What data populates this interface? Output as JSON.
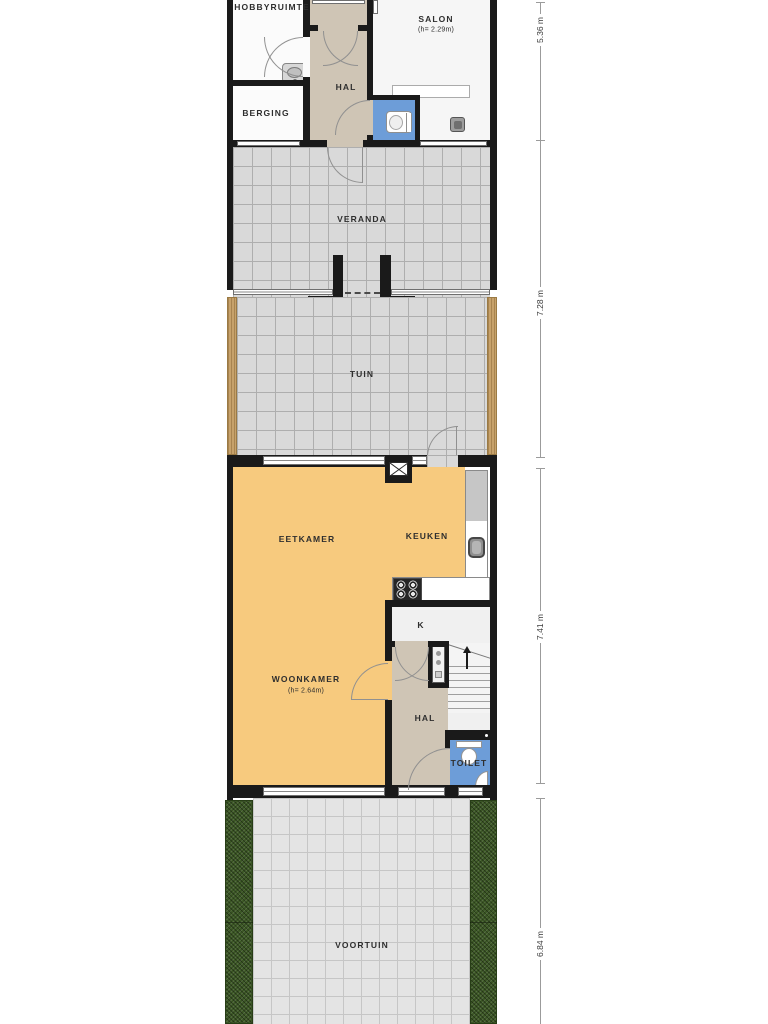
{
  "rooms": {
    "hobbyruimte": {
      "label": "HOBBYRUIMTE"
    },
    "salon": {
      "label": "SALON",
      "height_note": "(h= 2.29m)"
    },
    "hal_boven": {
      "label": "HAL"
    },
    "berging": {
      "label": "BERGING"
    },
    "veranda": {
      "label": "VERANDA"
    },
    "tuin": {
      "label": "TUIN"
    },
    "eetkamer": {
      "label": "EETKAMER"
    },
    "keuken": {
      "label": "KEUKEN"
    },
    "woonkamer": {
      "label": "WOONKAMER",
      "height_note": "(h= 2.64m)"
    },
    "kast": {
      "label": "K"
    },
    "hal": {
      "label": "HAL"
    },
    "toilet": {
      "label": "TOILET"
    },
    "voortuin": {
      "label": "VOORTUIN"
    }
  },
  "dimensions": [
    {
      "label": "5.36 m"
    },
    {
      "label": "7.28 m"
    },
    {
      "label": "7.41 m"
    },
    {
      "label": "6.84 m"
    }
  ],
  "colors": {
    "wall": "#1a1a1a",
    "living_floor": "#f7ca7e",
    "hall_floor": "#cfc5b5",
    "toilet_floor": "#6d9dd8",
    "terrace_tile": "#d9d9d9",
    "front_tile": "#e4e4e4",
    "hedge_green": "#3b5724",
    "wood_edge": "#c7a26b"
  },
  "icons": {
    "stove": "stove-icon",
    "kitchen_sink": "sink-icon",
    "salon_sink": "sink-icon",
    "hobby_sink": "sink-icon",
    "toilet_top": "toilet-icon",
    "toilet_main": "toilet-icon",
    "corner_sink": "sink-icon",
    "flue": "flue-icon",
    "boiler": "boiler-icon",
    "stairs_arrow": "arrow-up-icon"
  }
}
